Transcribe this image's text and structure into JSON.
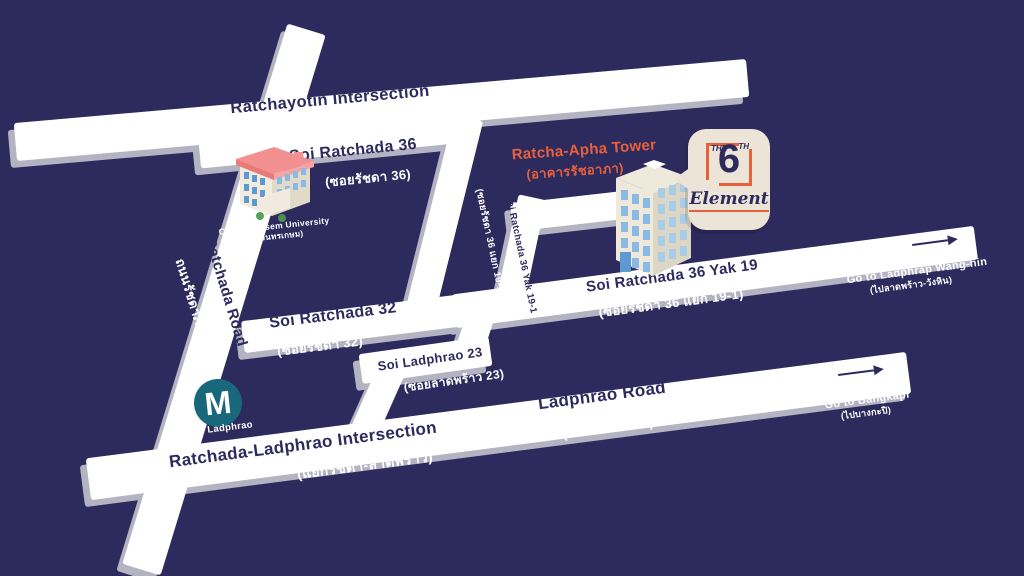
{
  "title": "The 6th Element location map",
  "colors": {
    "background": "#2d2b5e",
    "road": "#ffffff",
    "road_side": "#b4b3c1",
    "road_text": "#2d2b5e",
    "light_text": "#ffffff",
    "accent_orange": "#e8603c",
    "mrt_circle": "#19677a",
    "bubble": "#ece4d6"
  },
  "roads": {
    "ratchayotin": {
      "name_en": "Ratchayotin Intersection",
      "name_th": "(แยกรัชโยธิน)"
    },
    "soi_ratchada_36": {
      "name_en": "Soi Ratchada 36",
      "name_th": "(ซอยรัชดา 36)"
    },
    "ratchada_road": {
      "name_en": "Ratchada Road",
      "name_th": "ถนนรัชดาภิเษก"
    },
    "soi_ratchada_32": {
      "name_en": "Soi Ratchada 32",
      "name_th": "(ซอยรัชดา 32)"
    },
    "soi_ladphrao_23": {
      "name_en": "Soi Ladphrao 23",
      "name_th": "(ซอยลาดพร้าว 23)"
    },
    "soi_ratchada_36_yak_19": {
      "name_en": "Soi Ratchada 36 Yak 19",
      "name_th": "(ซอยรัชดา 36 แยก 19-1)"
    },
    "soi_ratchada_36_yak_19_1": {
      "name_en": "Soi Ratchada 36 Yak 19-1",
      "name_th": "(ซอยรัชดา 36 แยก 19-1)"
    },
    "ladphrao_road": {
      "name_en": "Ladphrao Road",
      "name_th": "(ถนนลาดพร้าว)"
    },
    "ratchada_ladphrao": {
      "name_en": "Ratchada-Ladphrao Intersection",
      "name_th": "(แยกรัชดา-ลาดพร้าว)"
    }
  },
  "directions": {
    "wanghin": {
      "en": "Go to Ladphrap Wang-hin",
      "th": "(ไปลาดพร้าว-วังหิน)"
    },
    "bangkapi": {
      "en": "Go to Bangkapi",
      "th": "(ไปบางกะปิ)"
    }
  },
  "places": {
    "university": {
      "en": "Chandrakasem University",
      "th": "(มรภ. จันทรเกษม)"
    },
    "tower": {
      "en": "Ratcha-Apha Tower",
      "th": "(อาคารรัชอาภา)"
    },
    "mrt": {
      "letter": "M",
      "label": "MRT Ladphrao"
    }
  },
  "logo": {
    "the": "THE",
    "number": "6",
    "th": "TH",
    "script": "Element"
  }
}
